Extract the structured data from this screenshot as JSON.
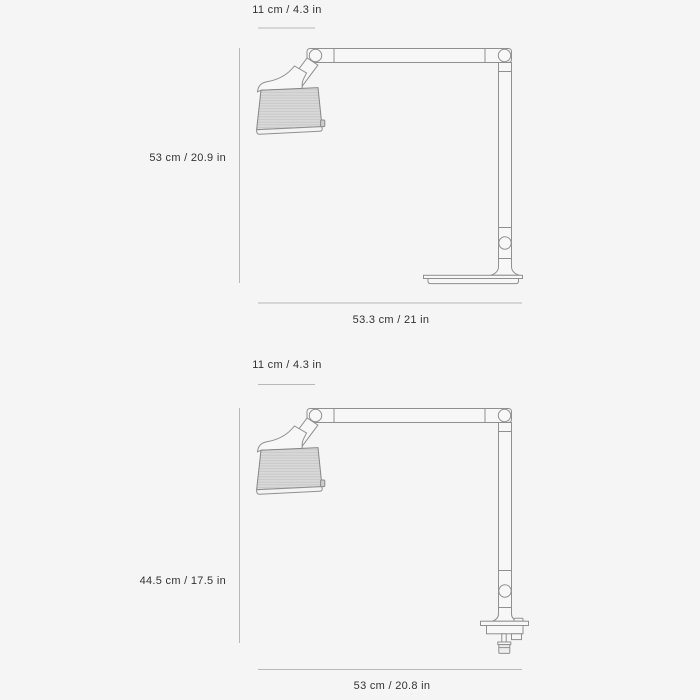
{
  "page": {
    "background_color": "#f5f5f5",
    "outline_color": "#909090",
    "dimension_line_color": "#b8b8b8",
    "text_color": "#333333"
  },
  "figures": [
    {
      "variant": "freestanding-base",
      "dimensions": {
        "head_width": "11 cm / 4.3 in",
        "height": "53 cm / 20.9 in",
        "depth": "53.3 cm / 21 in"
      }
    },
    {
      "variant": "clamp-mount",
      "dimensions": {
        "head_width": "11 cm / 4.3 in",
        "height": "44.5 cm / 17.5 in",
        "depth": "53 cm / 20.8 in"
      }
    }
  ]
}
